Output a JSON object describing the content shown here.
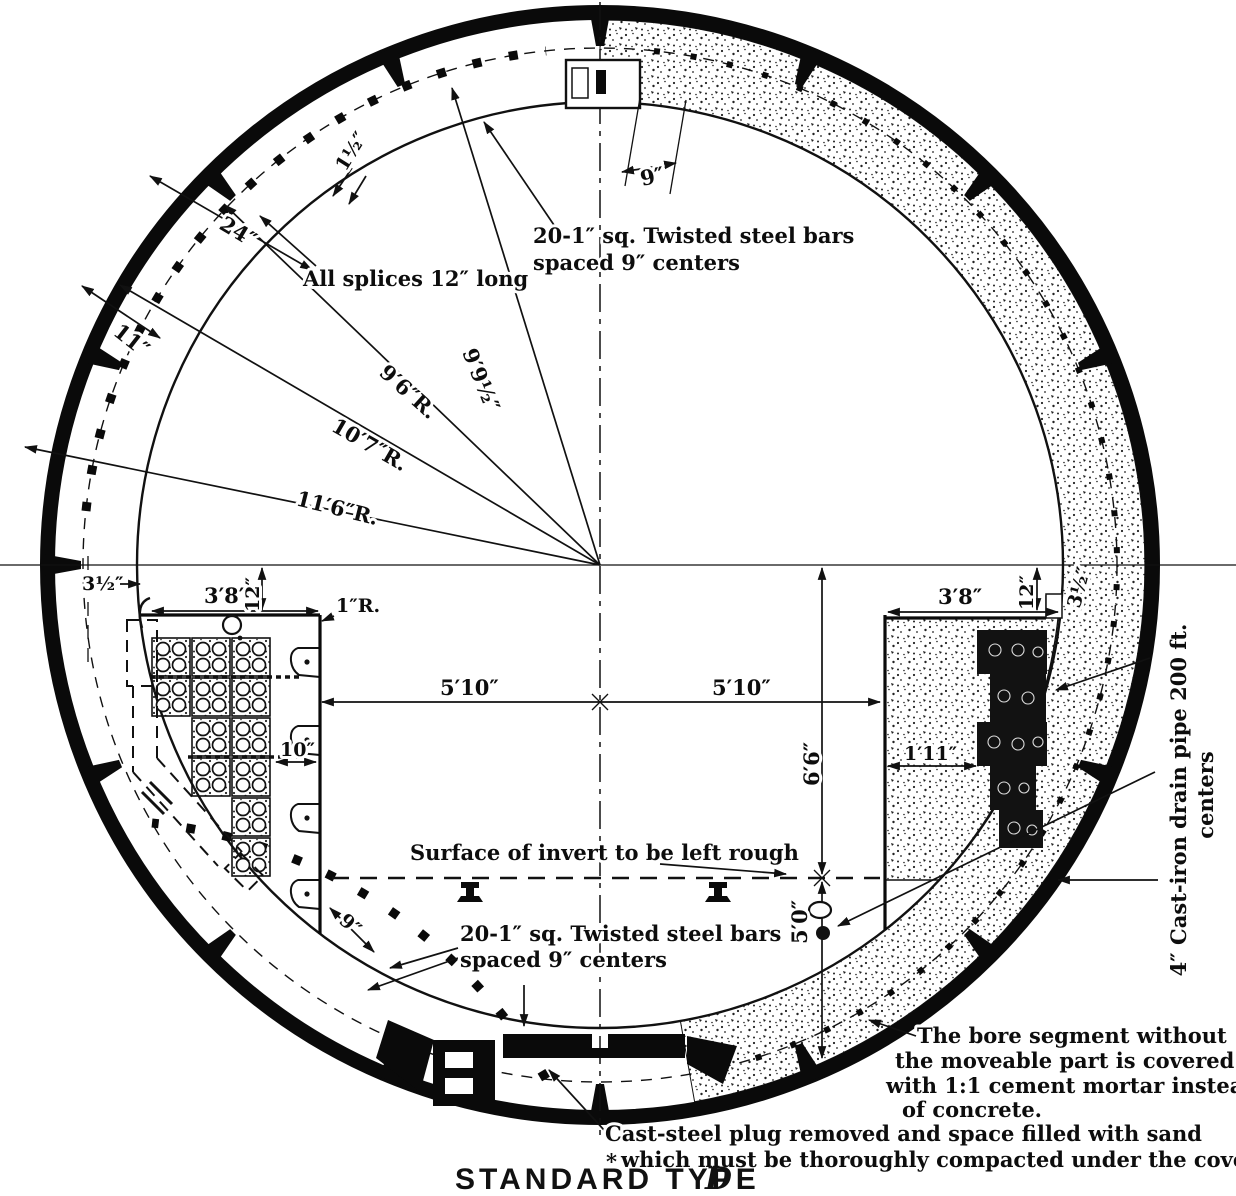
{
  "title": {
    "main": "STANDARD TYPE",
    "type_letter": "D"
  },
  "annotations": {
    "top_bars_l1": "20-1″ sq. Twisted steel bars",
    "top_bars_l2": "spaced 9″ centers",
    "splices": "All splices 12″ long",
    "invert_rough": "Surface of invert to be left rough",
    "bottom_bars_l1": "20-1″ sq. Twisted steel bars",
    "bottom_bars_l2": "spaced 9″ centers",
    "mortar_l1": "The bore segment without",
    "mortar_l2": "the moveable part is covered",
    "mortar_l3": "with 1:1 cement mortar instead",
    "mortar_l4": "of concrete.",
    "plug_star": "*",
    "plug_l1": "Cast-steel plug removed and space filled with sand",
    "plug_l2": "which must be thoroughly compacted under the cover",
    "drain_l1": "4″ Cast-iron drain pipe 200 ft.",
    "drain_l2": "centers"
  },
  "dimensions": {
    "r_116": "11′6″R.",
    "r_107": "10′7″R.",
    "r_96": "9′6″R.",
    "r_9912": "9′9½″",
    "d24": "24″",
    "d11": "11″",
    "d9_top": "9″",
    "d1h": "1½″",
    "d3h_left": "3½″",
    "d38_left": "3′8″",
    "d12_left": "12″",
    "r1_left": "1″R.",
    "d38_right": "3′8″",
    "d12_right": "12″",
    "d3h_right": "3½″",
    "d510_left": "5′10″",
    "d510_right": "5′10″",
    "d66": "6′6″",
    "d50": "5′0″",
    "d10": "10″",
    "d111": "1′11″",
    "d9_bottom": "9″"
  }
}
